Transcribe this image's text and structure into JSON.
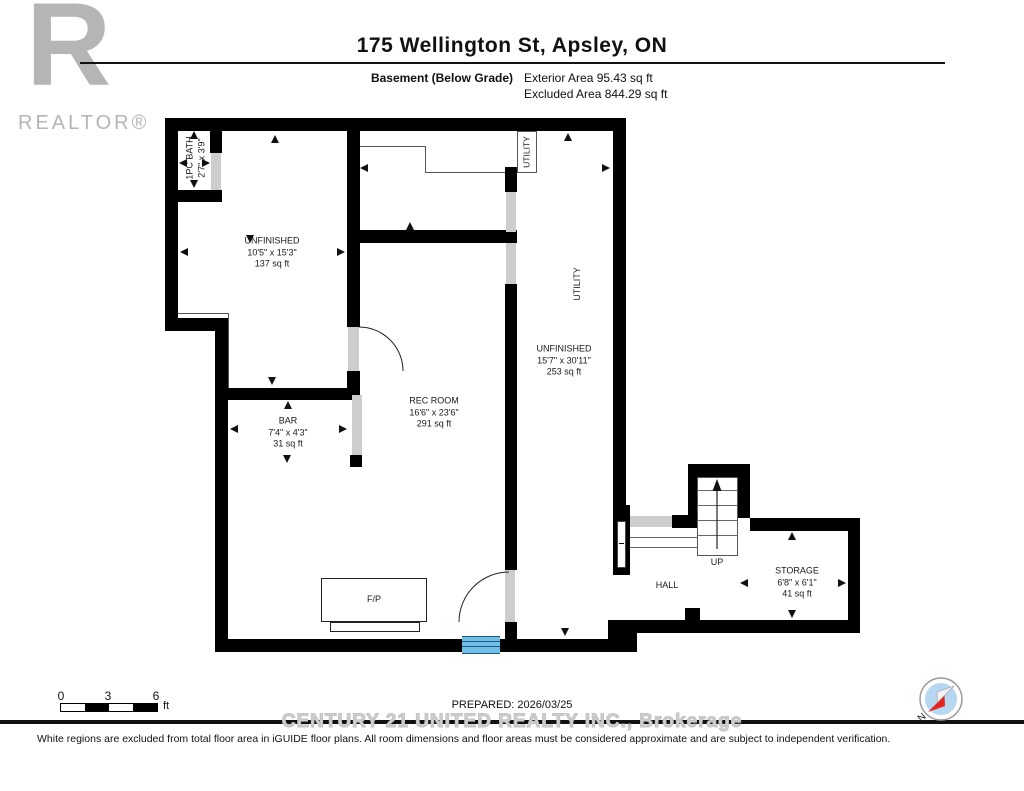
{
  "header": {
    "title": "175 Wellington St, Apsley, ON",
    "floor_label": "Basement (Below Grade)",
    "exterior_area": "Exterior Area 95.43 sq ft",
    "excluded_area": "Excluded Area 844.29 sq ft"
  },
  "logo": {
    "r": "R",
    "realtor": "REALTOR®"
  },
  "rooms": {
    "bath": {
      "name": "1PC BATH",
      "dims": "2'7\" x 3'9\""
    },
    "unfinished_left": {
      "name": "UNFINISHED",
      "dims": "10'5\" x 15'3\"",
      "area": "137 sq ft"
    },
    "bar": {
      "name": "BAR",
      "dims": "7'4\" x 4'3\"",
      "area": "31 sq ft"
    },
    "rec_room": {
      "name": "REC ROOM",
      "dims": "16'6\" x 23'6\"",
      "area": "291 sq ft"
    },
    "utility_closet": {
      "name": "UTILITY"
    },
    "utility_area": {
      "name": "UTILITY"
    },
    "unfinished_right": {
      "name": "UNFINISHED",
      "dims": "15'7\" x 30'11\"",
      "area": "253 sq ft"
    },
    "storage": {
      "name": "STORAGE",
      "dims": "6'8\" x 6'1\"",
      "area": "41 sq ft"
    },
    "hall": {
      "name": "HALL"
    },
    "stairs": {
      "label": "UP"
    },
    "fireplace": {
      "label": "F/P"
    }
  },
  "footer": {
    "scale": {
      "t0": "0",
      "t3": "3",
      "t6": "6",
      "unit": "ft"
    },
    "prepared": "PREPARED: 2026/03/25",
    "watermark": "CENTURY 21 UNITED REALTY INC., Brokerage",
    "disclaimer": "White regions are excluded from total floor area in iGUIDE floor plans. All room dimensions and floor areas must be considered approximate and are subject to independent verification.",
    "compass_north": "N"
  },
  "colors": {
    "wall": "#000000",
    "door_opening": "#cdcdcd",
    "window_blue": "#6fbfe9",
    "watermark_gray": "#cfcfcf",
    "logo_gray": "#b5b5b5",
    "compass_red": "#e8211d",
    "compass_blue": "#b5d7f2"
  }
}
